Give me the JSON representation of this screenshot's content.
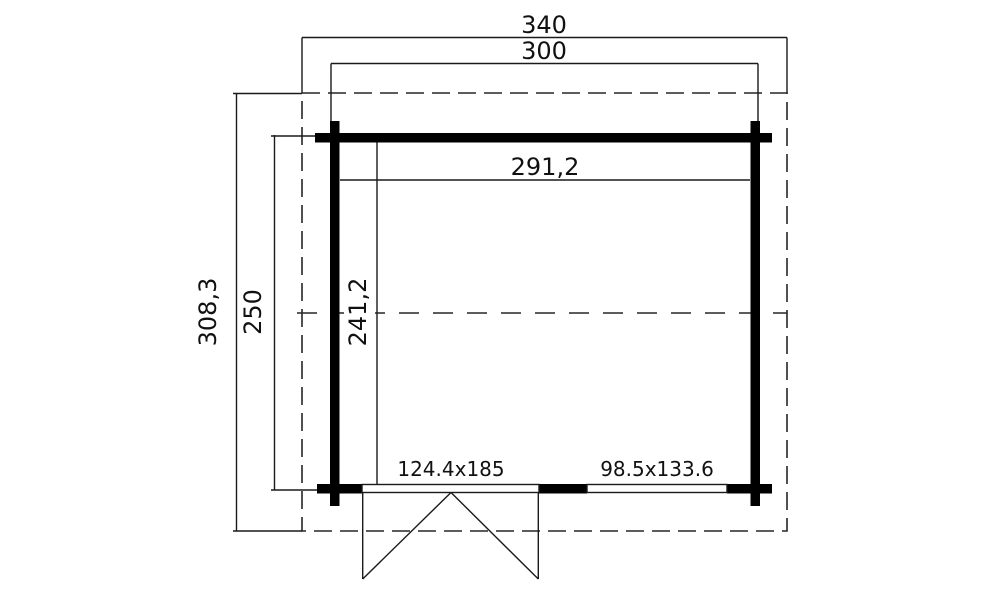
{
  "drawing": {
    "type": "floor-plan",
    "background_color": "#ffffff",
    "line_color": "#1a1a1a",
    "wall_color": "#000000",
    "dimensions": {
      "roof_width": "340",
      "wall_width": "300",
      "inner_width": "291,2",
      "roof_depth": "308,3",
      "wall_depth": "250",
      "inner_depth": "241,2"
    },
    "openings": {
      "door_size": "124.4x185",
      "window_size": "98.5x133.6"
    }
  }
}
